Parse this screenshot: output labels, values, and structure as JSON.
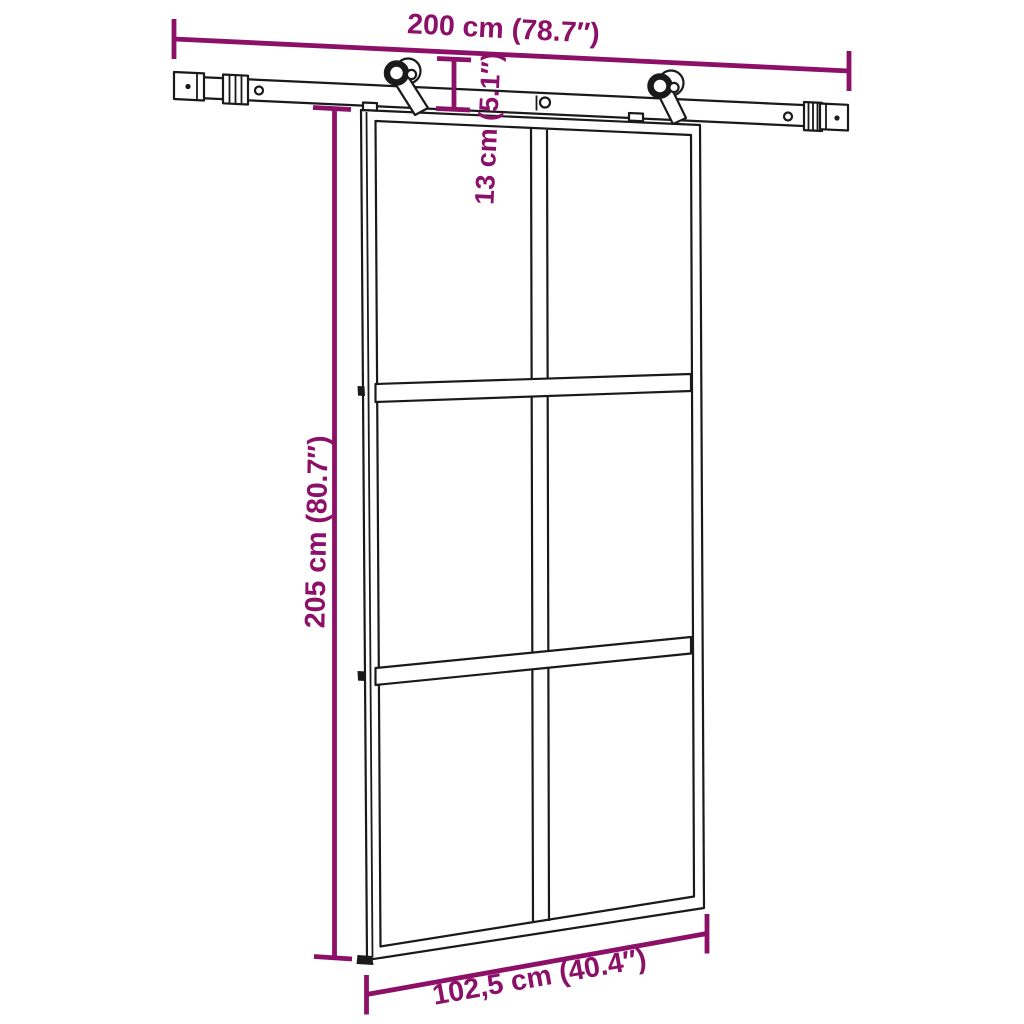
{
  "diagram": {
    "kind": "product-dimension-diagram",
    "subject": "sliding glass door with steel sliding rail hardware kit, 6-panel grid",
    "dimensions": {
      "rail_width": "200 cm (78.7″)",
      "hanger_drop": "13 cm (5.1″)",
      "door_height": "205 cm (80.7″)",
      "door_width": "102,5 cm (40.4″)"
    },
    "colors": {
      "dimension": "#8C0F68",
      "ink": "#1a1a1a",
      "background": "#ffffff"
    }
  }
}
